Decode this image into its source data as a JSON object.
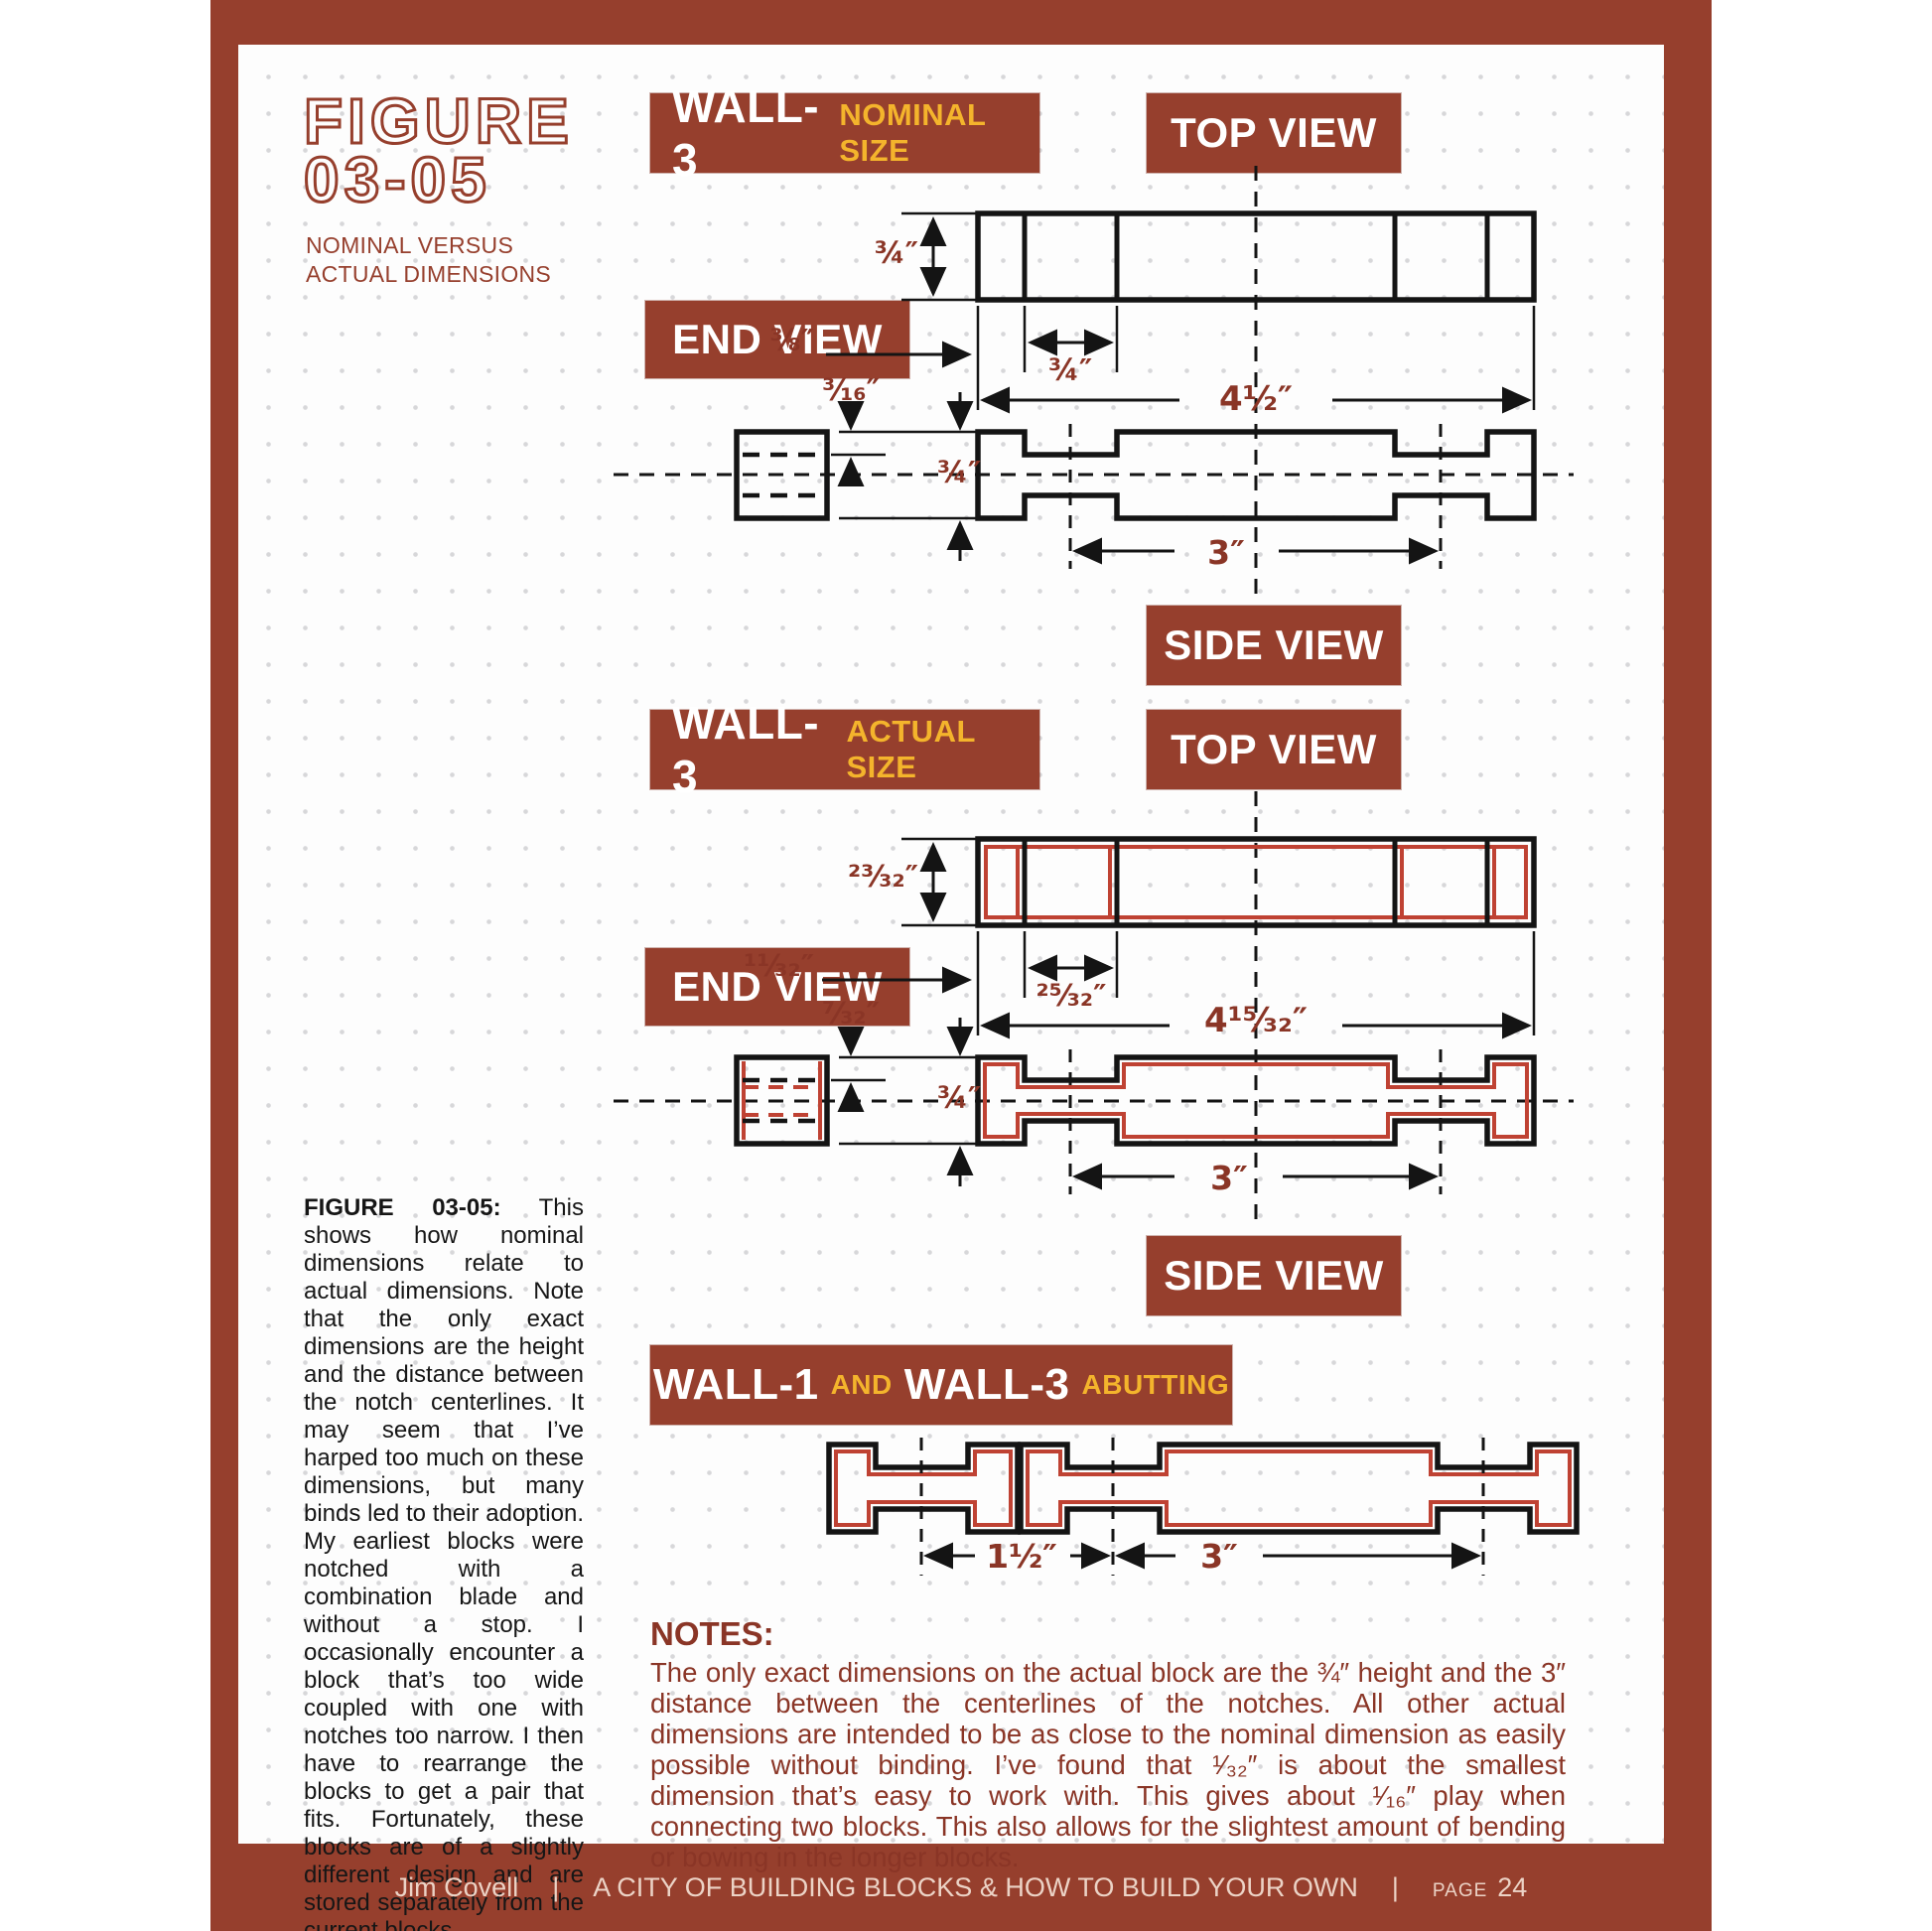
{
  "figure": {
    "label_line1": "FIGURE",
    "label_line2": "03-05",
    "subtitle_line1": "NOMINAL VERSUS",
    "subtitle_line2": "ACTUAL DIMENSIONS"
  },
  "banners": {
    "wall3_nominal": {
      "title": "WALL-3",
      "subtitle": "NOMINAL SIZE"
    },
    "top_view_1": "TOP VIEW",
    "end_view_1": "END VIEW",
    "side_view_1": "SIDE VIEW",
    "wall3_actual": {
      "title": "WALL-3",
      "subtitle": "ACTUAL SIZE"
    },
    "top_view_2": "TOP VIEW",
    "end_view_2": "END VIEW",
    "side_view_2": "SIDE VIEW",
    "abutting": {
      "wall1": "WALL-1",
      "and": "AND",
      "wall3": "WALL-3",
      "subtitle": "ABUTTING"
    }
  },
  "dimensions": {
    "nominal": {
      "height": "¾″",
      "edge_offset": "⅜″",
      "notch_width": "¾″",
      "overall_length": "4½″",
      "notch_depth": "³⁄₁₆″",
      "block_height": "¾″",
      "notch_spacing": "3″"
    },
    "actual": {
      "height": "²³⁄₃₂″",
      "edge_offset": "¹¹⁄₃₂″",
      "notch_width": "²⁵⁄₃₂″",
      "overall_length": "4¹⁵⁄₃₂″",
      "notch_depth": "⁷⁄₃₂″",
      "block_height": "¾″",
      "notch_spacing": "3″"
    },
    "abutting": {
      "wall1_spacing": "1½″",
      "wall3_spacing": "3″"
    }
  },
  "caption": {
    "lead": "FIGURE 03-05:",
    "body": " This shows how nominal dimensions relate to actual dimensions. Note that the only exact dimensions are the height and the distance between the notch centerlines. It may seem that I’ve harped too much on these dimensions, but many binds led to their adoption. My earliest blocks were notched with a combination blade and without a stop. I occasionally encounter a block that’s too wide coupled with one with notches too narrow. I then have to rearrange the blocks to get a pair that fits. Fortunately, these blocks are of a slightly different design and are stored separately from the current blocks."
  },
  "notes": {
    "heading": "NOTES:",
    "body": "The only exact dimensions on the actual block are the ¾″ height and the 3″ distance between the centerlines of the notches. All other actual dimensions are intended to be as close to the nominal dimension as easily possible without binding. I’ve found that ¹⁄₃₂″ is about the smallest dimension that’s easy to work with. This gives about ¹⁄₁₆″ play when connecting two blocks. This also allows for the slightest amount of bending or bowing in the longer blocks."
  },
  "footer": {
    "author": "Jim Covell",
    "separator": "|",
    "book_title": "A CITY OF BUILDING BLOCKS & HOW TO BUILD YOUR OWN",
    "page_label": "PAGE",
    "page_number": "24"
  },
  "colors": {
    "brick": "#963f2d",
    "dim_text": "#8a3526",
    "accent_yellow": "#f4b42c",
    "line_black": "#141414",
    "line_red": "#bf4233",
    "footer_text": "#ecd3c6"
  }
}
